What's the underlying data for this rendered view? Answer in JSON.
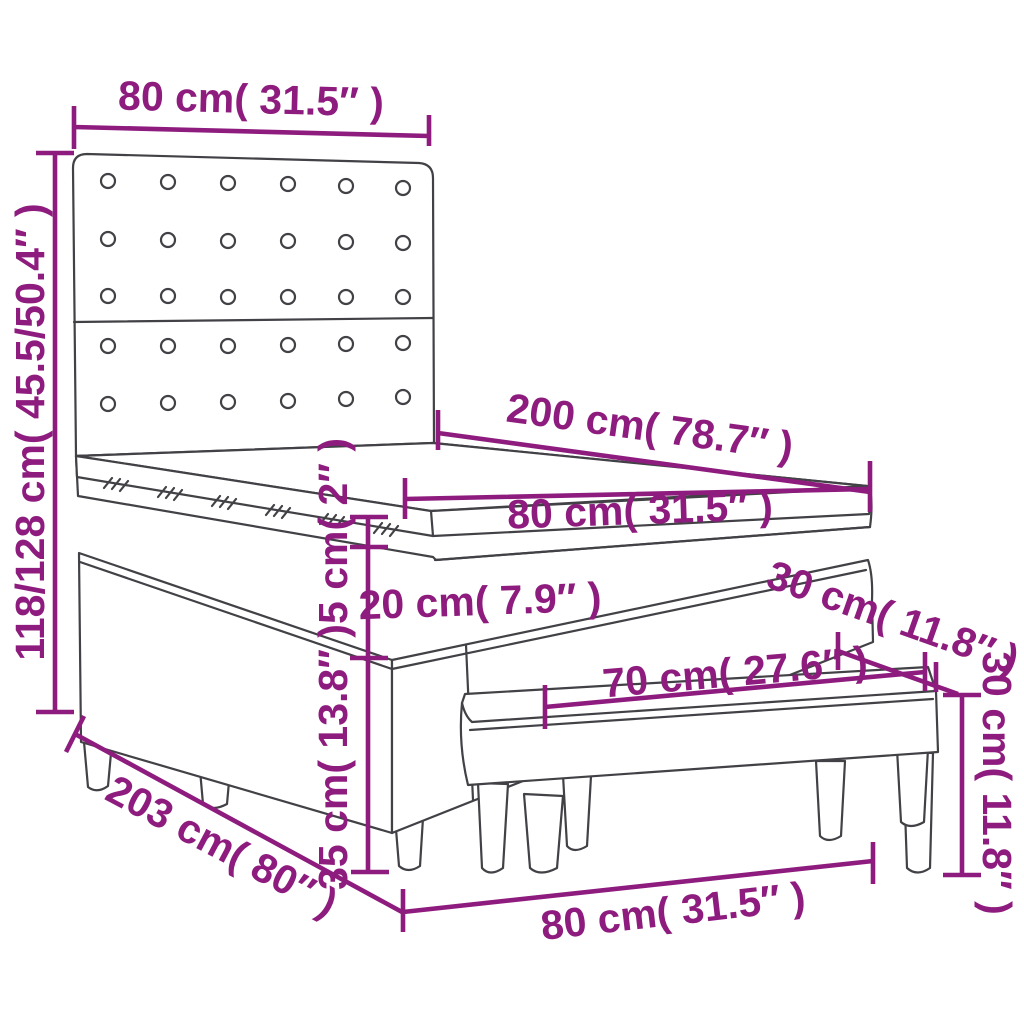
{
  "diagram": {
    "kind": "product-dimension-diagram",
    "product": "box spring bed with tufted headboard, mattress topper and bench",
    "accent_color": "#8E1C7E",
    "line_color": "#414146",
    "background_color": "#FFFFFF",
    "dims": [
      {
        "id": "headboard-width",
        "label": "80 cm( 31.5″ )"
      },
      {
        "id": "headboard-height",
        "label": "118/128 cm( 45.5/50.4″ )"
      },
      {
        "id": "bed-length",
        "label": "200 cm( 78.7″ )"
      },
      {
        "id": "bed-width",
        "label": "80 cm( 31.5″ )"
      },
      {
        "id": "topper-height",
        "label": "5 cm( 2″ )"
      },
      {
        "id": "mattress-height",
        "label": "20 cm( 7.9″ )"
      },
      {
        "id": "bench-depth",
        "label": "30 cm( 11.8″ )"
      },
      {
        "id": "bench-length",
        "label": "70 cm( 27.6″ )"
      },
      {
        "id": "bench-height",
        "label": "30 cm( 11.8″ )"
      },
      {
        "id": "base-height",
        "label": "35 cm( 13.8″ )"
      },
      {
        "id": "total-length",
        "label": "203 cm( 80″ )"
      },
      {
        "id": "bench-width",
        "label": "80 cm( 31.5″ )"
      }
    ]
  }
}
